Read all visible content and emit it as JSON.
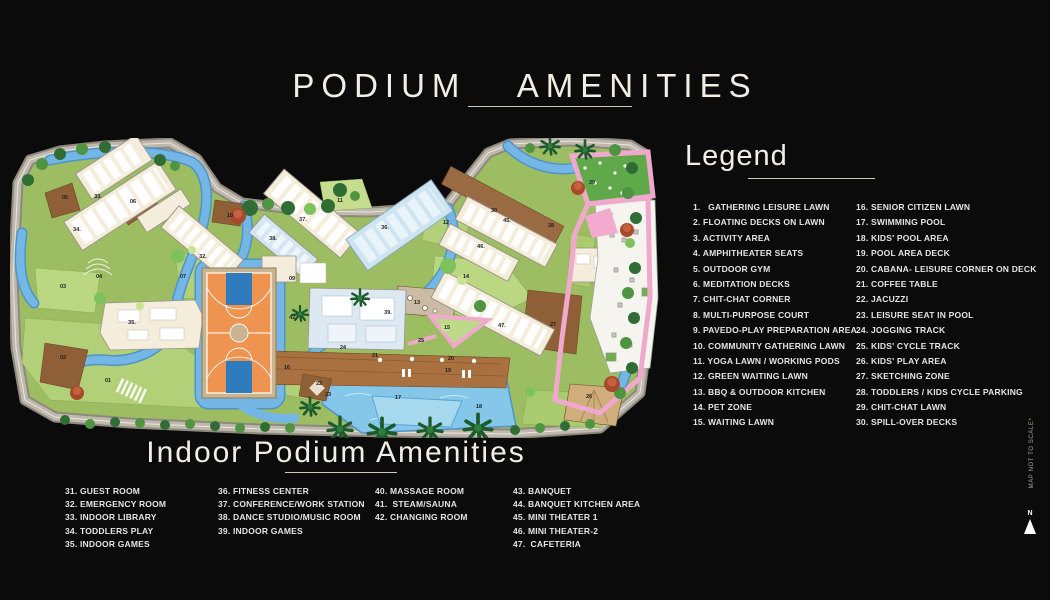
{
  "title": "PODIUM AMENITIES",
  "legend": {
    "heading": "Legend",
    "columns": [
      [
        "1.   GATHERING LEISURE LAWN",
        "2. FLOATING DECKS ON LAWN",
        "3. ACTIVITY AREA",
        "4. AMPHITHEATER SEATS",
        "5. OUTDOOR GYM",
        "6. MEDITATION DECKS",
        "7. CHIT-CHAT CORNER",
        "8. MULTI-PURPOSE COURT",
        "9. PAVEDO-PLAY PREPARATION AREA",
        "10. COMMUNITY GATHERING LAWN",
        "11. YOGA LAWN / WORKING PODS",
        "12. GREEN WAITING LAWN",
        "13. BBQ & OUTDOOR KITCHEN",
        "14. PET ZONE",
        "15. WAITING LAWN"
      ],
      [
        "16. SENIOR CITIZEN LAWN",
        "17. SWIMMING POOL",
        "18. KIDS' POOL AREA",
        "19. POOL AREA DECK",
        "20. CABANA- LEISURE CORNER ON DECK",
        "21. COFFEE TABLE",
        "22. JACUZZI",
        "23. LEISURE SEAT IN POOL",
        "24. JOGGING TRACK",
        "25. KIDS' CYCLE TRACK",
        "26. KIDS' PLAY AREA",
        "27. SKETCHING ZONE",
        "28. TODDLERS / KIDS CYCLE PARKING",
        "29. CHIT-CHAT LAWN",
        "30. SPILL-OVER DECKS"
      ]
    ]
  },
  "indoor": {
    "heading": "Indoor Podium Amenities",
    "columns": [
      [
        "31. GUEST ROOM",
        "32. EMERGENCY ROOM",
        "33. INDOOR LIBRARY",
        "34. TODDLERS PLAY",
        "35. INDOOR GAMES"
      ],
      [
        "36. FITNESS CENTER",
        "37. CONFERENCE/WORK STATION",
        "38. DANCE STUDIO/MUSIC ROOM",
        "39. INDOOR GAMES"
      ],
      [
        "40. MASSAGE ROOM",
        "41.  STEAM/SAUNA",
        "42. CHANGING ROOM"
      ],
      [
        "43. BANQUET",
        "44. BANQUET KITCHEN AREA",
        "45. MINI THEATER 1",
        "46. MINI THEATER-2",
        "47.  CAFETERIA"
      ]
    ]
  },
  "map": {
    "labels": [
      {
        "n": "01",
        "x": 98,
        "y": 243
      },
      {
        "n": "02",
        "x": 53,
        "y": 220
      },
      {
        "n": "03",
        "x": 53,
        "y": 149
      },
      {
        "n": "04",
        "x": 89,
        "y": 139
      },
      {
        "n": "05",
        "x": 55,
        "y": 60
      },
      {
        "n": "06",
        "x": 123,
        "y": 64
      },
      {
        "n": "07",
        "x": 173,
        "y": 139
      },
      {
        "n": "09",
        "x": 282,
        "y": 141
      },
      {
        "n": "10",
        "x": 220,
        "y": 78
      },
      {
        "n": "11",
        "x": 330,
        "y": 63
      },
      {
        "n": "12",
        "x": 436,
        "y": 85
      },
      {
        "n": "13",
        "x": 407,
        "y": 165
      },
      {
        "n": "14",
        "x": 456,
        "y": 139
      },
      {
        "n": "15",
        "x": 437,
        "y": 190
      },
      {
        "n": "16",
        "x": 277,
        "y": 230
      },
      {
        "n": "17",
        "x": 388,
        "y": 260
      },
      {
        "n": "18",
        "x": 469,
        "y": 269
      },
      {
        "n": "19",
        "x": 438,
        "y": 233
      },
      {
        "n": "20",
        "x": 441,
        "y": 221
      },
      {
        "n": "21",
        "x": 365,
        "y": 218
      },
      {
        "n": "22",
        "x": 309,
        "y": 246
      },
      {
        "n": "23",
        "x": 318,
        "y": 257
      },
      {
        "n": "24",
        "x": 333,
        "y": 210
      },
      {
        "n": "25",
        "x": 411,
        "y": 203
      },
      {
        "n": "26",
        "x": 579,
        "y": 259
      },
      {
        "n": "27",
        "x": 543,
        "y": 187
      },
      {
        "n": "28",
        "x": 541,
        "y": 88
      },
      {
        "n": "29",
        "x": 582,
        "y": 45
      },
      {
        "n": "30",
        "x": 484,
        "y": 73
      },
      {
        "n": "32.",
        "x": 193,
        "y": 119
      },
      {
        "n": "33.",
        "x": 88,
        "y": 59
      },
      {
        "n": "34.",
        "x": 67,
        "y": 92
      },
      {
        "n": "35.",
        "x": 122,
        "y": 185
      },
      {
        "n": "36.",
        "x": 375,
        "y": 90
      },
      {
        "n": "37.",
        "x": 293,
        "y": 82
      },
      {
        "n": "38.",
        "x": 263,
        "y": 101
      },
      {
        "n": "39.",
        "x": 378,
        "y": 175
      },
      {
        "n": "42.",
        "x": 283,
        "y": 180
      },
      {
        "n": "45.",
        "x": 497,
        "y": 83
      },
      {
        "n": "46.",
        "x": 471,
        "y": 109
      },
      {
        "n": "47.",
        "x": 492,
        "y": 188
      }
    ]
  },
  "footnote": "MAP NOT TO SCALE*",
  "compass_label": "N",
  "colors": {
    "background": "#0b0b0b",
    "heading_text": "#f3eee5",
    "list_text": "#e4e4e4",
    "water": "#74b7e6",
    "pool": "#85c7e8",
    "lawn": "#9cbd62",
    "lawn_light": "#b2d077",
    "building": "#f4eddb",
    "building_blue": "#cfe4f1",
    "court_orange": "#ef9450",
    "court_key_blue": "#2e7bbd",
    "deck_brown": "#8f6038",
    "track_pink": "#f0a9cd",
    "road_gray": "#beb8ad"
  }
}
